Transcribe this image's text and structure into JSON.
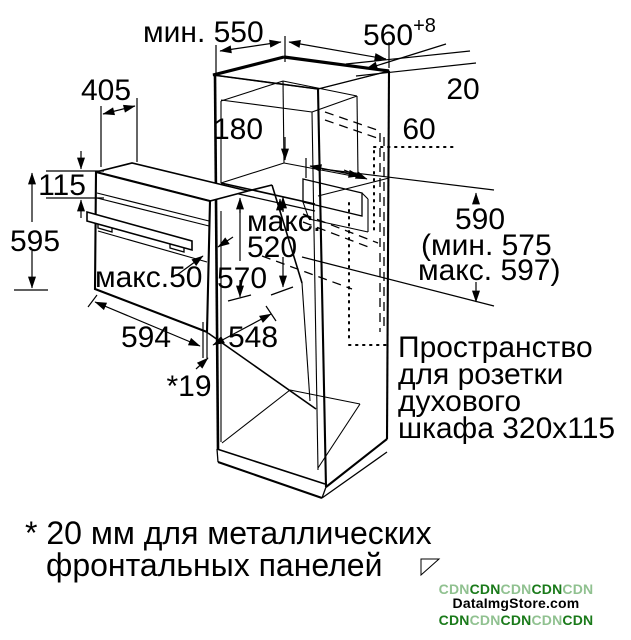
{
  "diagram_title": "oven-installation-dimensions",
  "labels": {
    "dim_min_depth": "мин. 550",
    "dim_width": "560",
    "dim_width_sup": "+8",
    "dim_rear_gap": "20",
    "dim_oven_top_depth": "405",
    "dim_vent_niche": "180",
    "dim_rear_clearance": "60",
    "dim_panel_height": "115",
    "dim_oven_height": "595",
    "dim_max_label": "макс.",
    "dim_max_value": "520",
    "dim_niche_height": "570",
    "dim_door_max": "макс.50",
    "dim_side_height": "590",
    "dim_side_min": "(мин. 575",
    "dim_side_max": "макс. 597)",
    "dim_oven_width": "594",
    "dim_oven_depth": "548",
    "dim_front_offset": "*19"
  },
  "socket_note": {
    "line1": "Пространство",
    "line2": "для розетки",
    "line3": "духового",
    "line4": "шкафа 320x115"
  },
  "footnote": {
    "line1": "* 20 мм для металлических",
    "line2": "фронтальных панелей"
  },
  "watermark": {
    "cdn": "CDN",
    "site": "DataImgStore.com",
    "color_dark": "#1a7a1a",
    "color_light": "#90c190"
  },
  "colors": {
    "ink": "#000000",
    "background": "#ffffff"
  }
}
